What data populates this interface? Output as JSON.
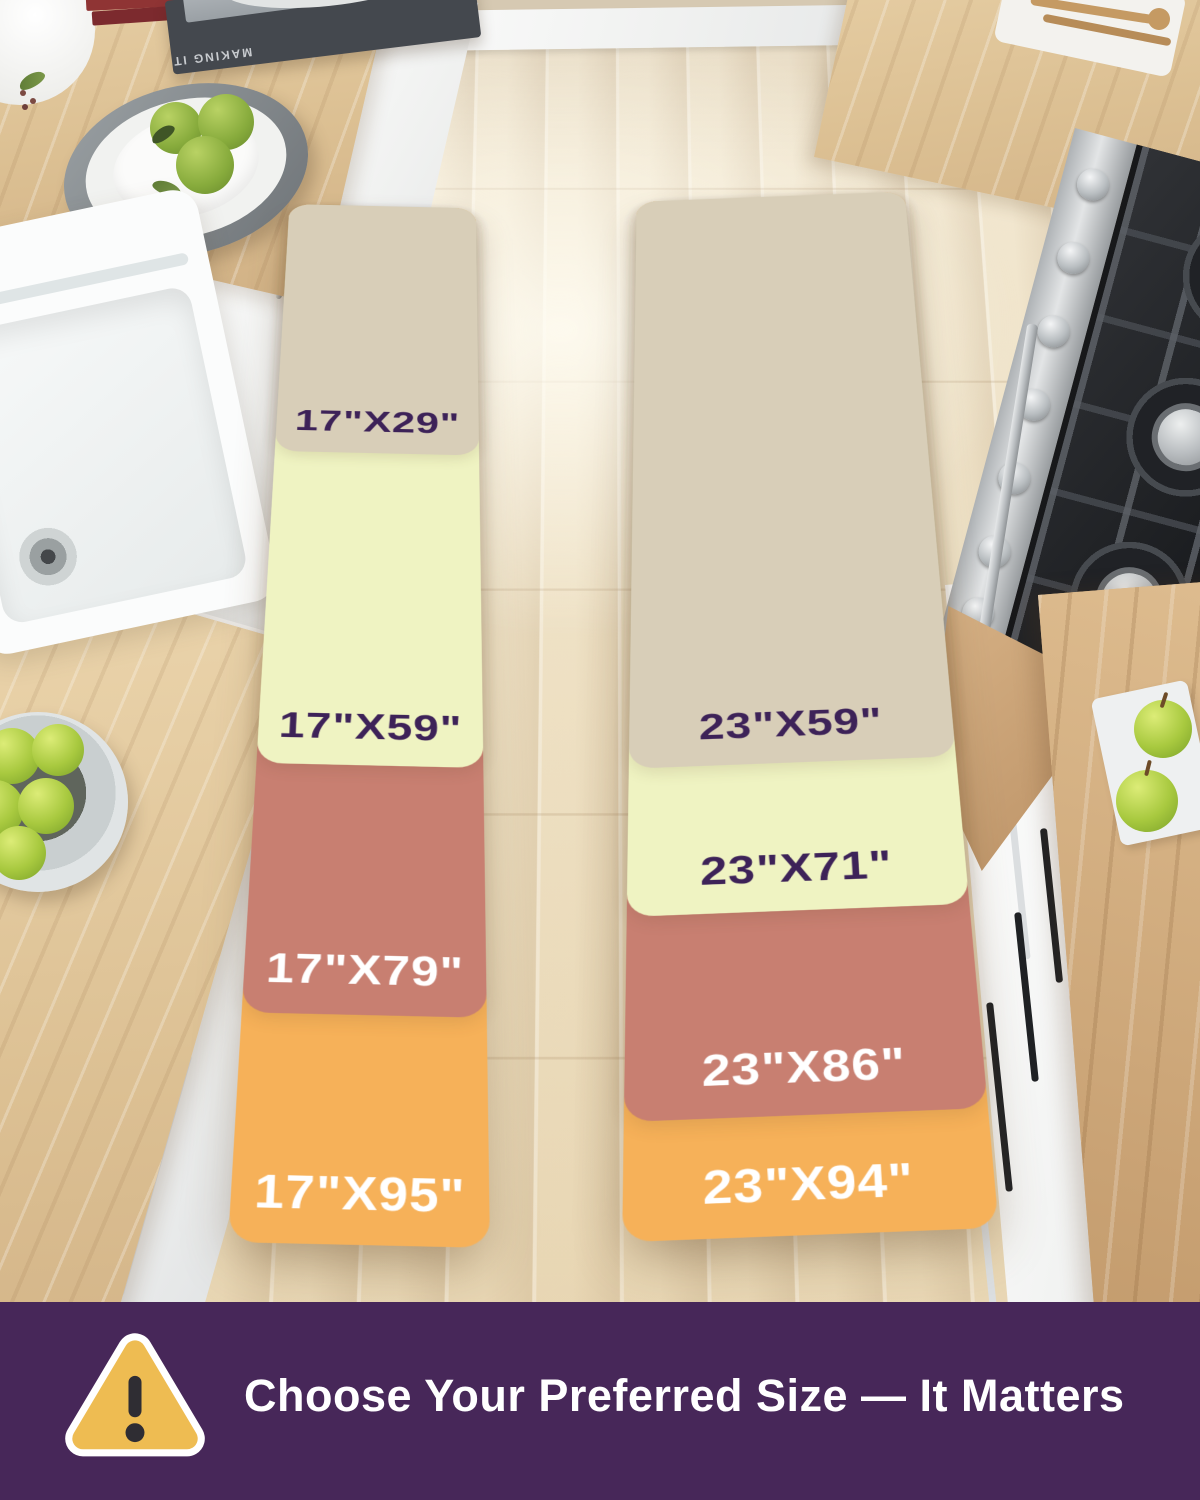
{
  "size_chart": {
    "columns": [
      {
        "id": "runner-17",
        "mats": [
          {
            "label": "17\"X29\"",
            "bg": "#d8ceb8",
            "fg": "#3d2258"
          },
          {
            "label": "17\"X59\"",
            "bg": "#eff3c2",
            "fg": "#3d2258"
          },
          {
            "label": "17\"X79\"",
            "bg": "#c87f71",
            "fg": "#ffffff"
          },
          {
            "label": "17\"X95\"",
            "bg": "#f6b159",
            "fg": "#ffffff"
          }
        ]
      },
      {
        "id": "runner-23",
        "mats": [
          {
            "label": "23\"X59\"",
            "bg": "#d8ceb8",
            "fg": "#3d2258"
          },
          {
            "label": "23\"X71\"",
            "bg": "#eff3c2",
            "fg": "#3d2258"
          },
          {
            "label": "23\"X86\"",
            "bg": "#c87f71",
            "fg": "#ffffff"
          },
          {
            "label": "23\"X94\"",
            "bg": "#f6b159",
            "fg": "#ffffff"
          }
        ]
      }
    ]
  },
  "banner": {
    "headline": "Choose Your Preferred Size — It Matters",
    "background_color": "#472759",
    "warning_icon": {
      "name": "warning-triangle-icon",
      "fill": "#eebc52",
      "mark": "#2f2d33",
      "border": "#ffffff"
    }
  },
  "scene": {
    "decor": {
      "book_spine_text": "MAKING IT"
    },
    "palette": {
      "floor": "#efe2c8",
      "plank": "#d9c4a1",
      "wood": "#e2c89e",
      "wood_deep": "#cfa97a",
      "cab_white": "#f0f1f0",
      "stainless": "#c7cacc",
      "stove_dark": "#26282c",
      "sink_white": "#fbfcfc",
      "apple": "#a8c93f",
      "lime": "#87ab3c"
    }
  }
}
